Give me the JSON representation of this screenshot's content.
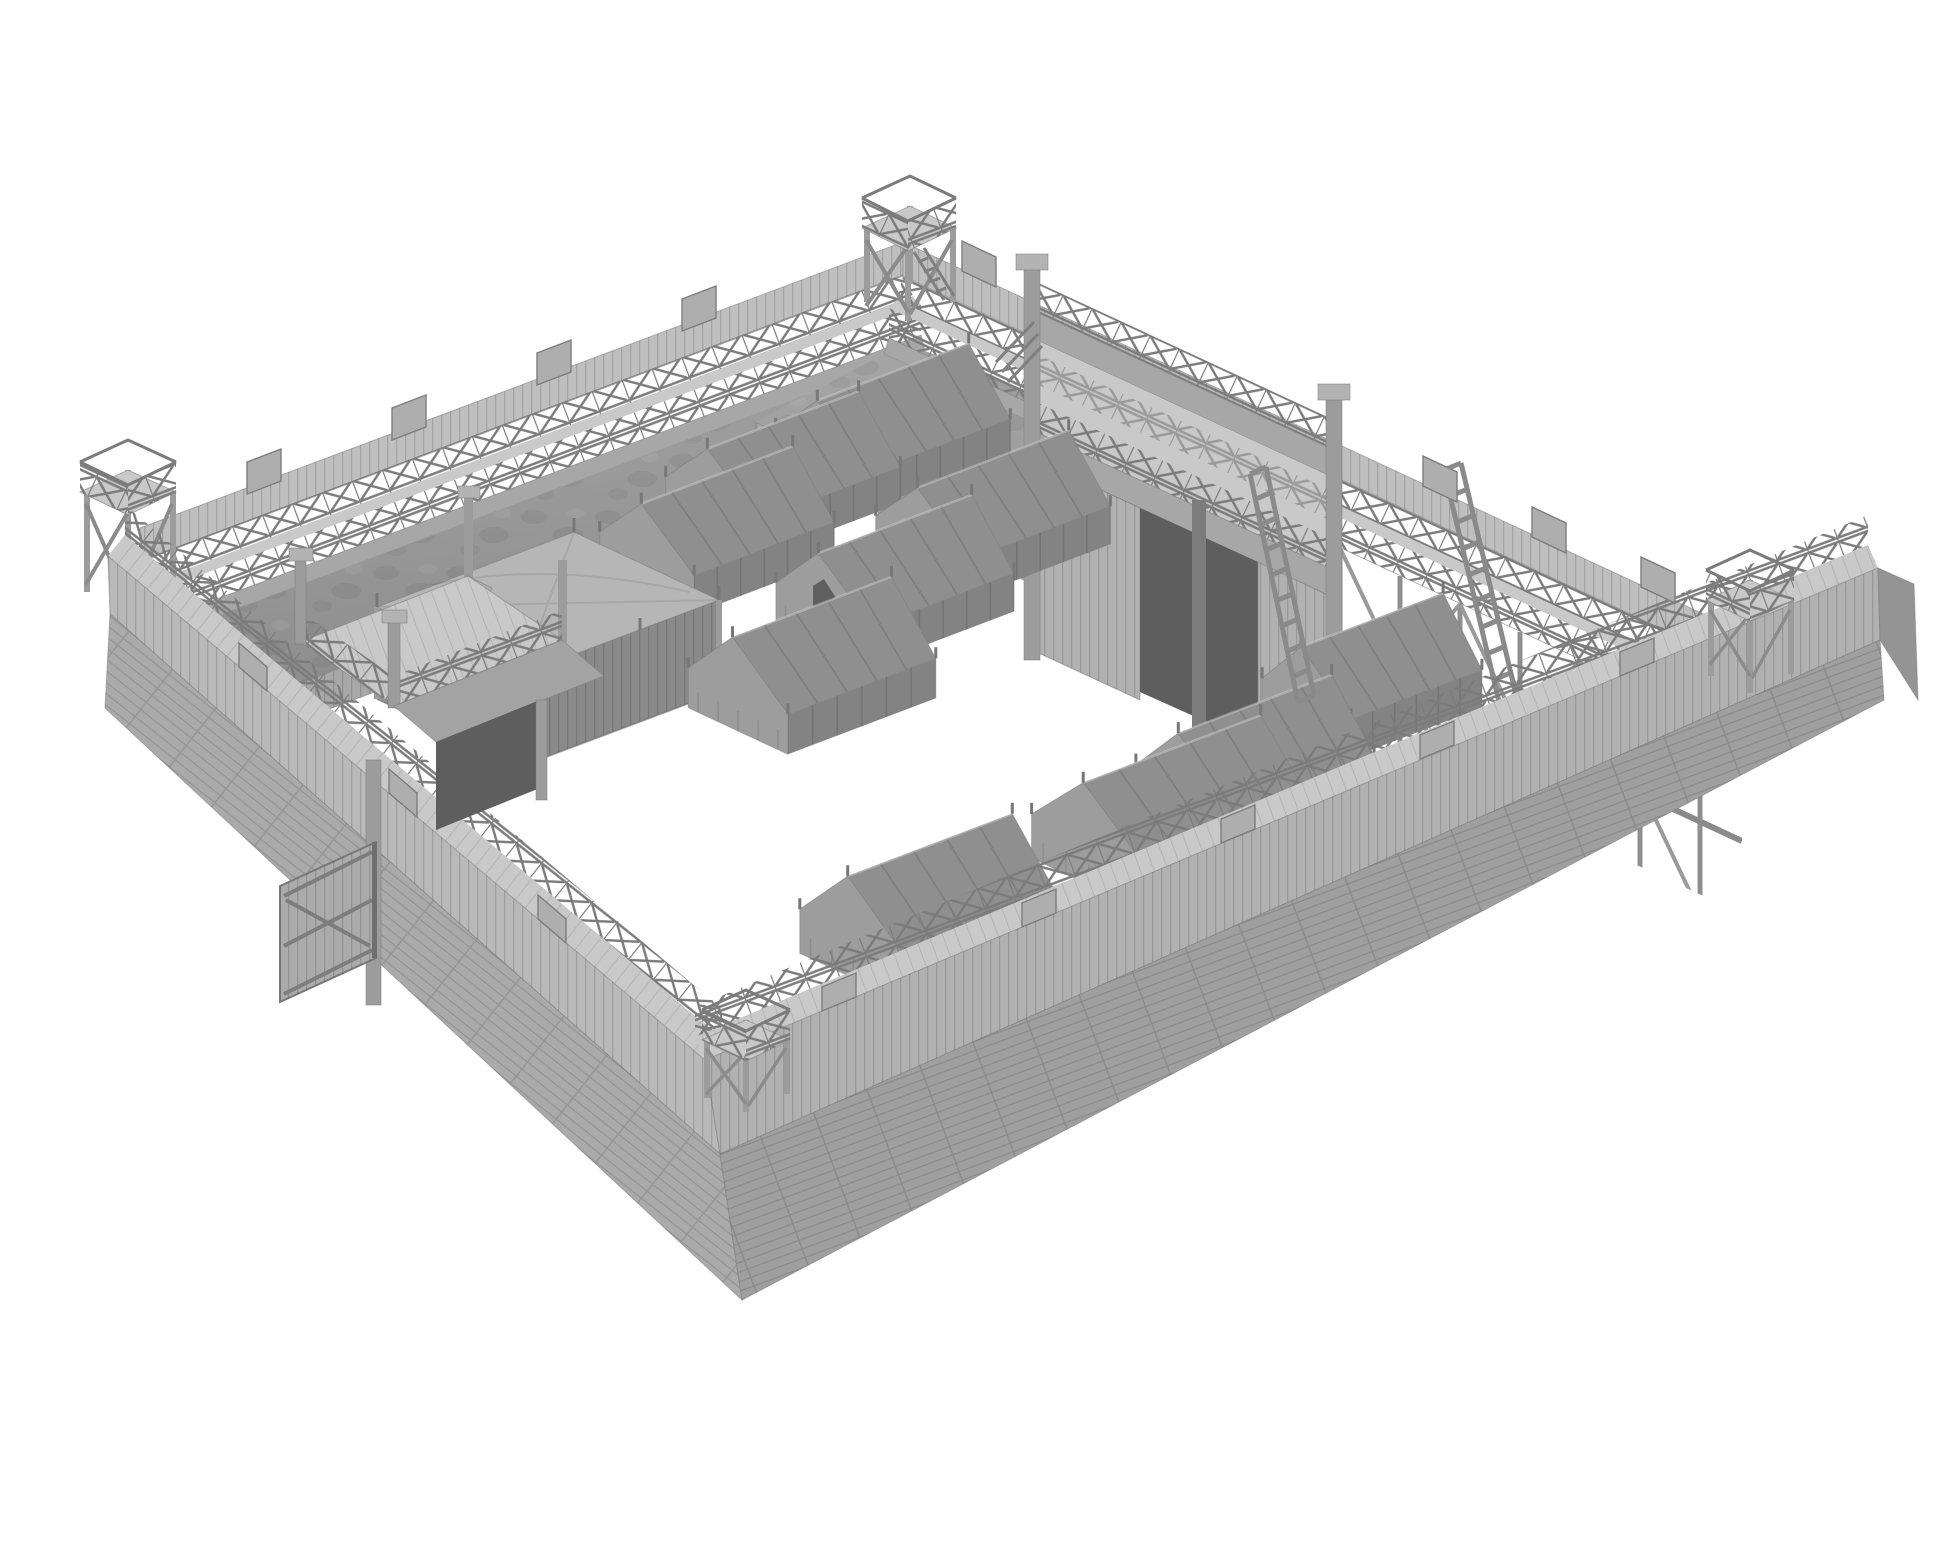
{
  "page": {
    "background": "#ffffff",
    "description": "Monochrome grey 3D render of a wooden palisade fort (Roman-style marching camp) shown in high isometric view on a plain white background. No text, UI chrome or labels are visible."
  },
  "colors": {
    "bg": "#ffffff",
    "paleTop": "#c9c9c9",
    "palisade": "#bfbfbf",
    "beamBand": "#a7a7a7",
    "earthLight": "#a3a3a3",
    "earthDark": "#8d8d8d",
    "revet": "#a8a8a8",
    "extVertSW": "#b9b9b9",
    "extHorizSW": "#aaaaaa",
    "extVertSE": "#b1b1b1",
    "extHorizSE": "#9f9f9f",
    "sideFacet": "#949494",
    "tentNear": "#8f8f8f",
    "tentFar": "#767676",
    "tentGable": "#9d9d9d",
    "tentSkirt": "#838383",
    "tentDark": "#5f5f5f",
    "pavTop": "#b6b6b6",
    "pavSide": "#9a9a9a",
    "pavFront": "#8a8a8a",
    "wood": "#aeaeae",
    "woodDark": "#8a8a8a",
    "postTone": "#9c9c9c",
    "capTone": "#b3b3b3",
    "gateDark": "#5e5e5e",
    "lattice": "#7b7b7b",
    "line": "#6f6f6f"
  },
  "scene": {
    "subject": "wooden fort model render",
    "view": "isometric from above, rotated rectangle, white void background",
    "fort": {
      "walls": [
        {
          "side": "northwest",
          "inner_face": "earth rampart with walkway, double cross-braced railing, log revetment"
        },
        {
          "side": "northeast",
          "inner_face": "earth rampart, walkway, open timber trestle section near east corner"
        },
        {
          "side": "southwest",
          "outer_face": "vertical stake palisade over horizontal log planking"
        },
        {
          "side": "southeast",
          "outer_face": "vertical stake palisade over horizontal log planking"
        }
      ],
      "corner_watchtowers": 4,
      "gatehouses": [
        {
          "side": "northeast",
          "stories": 2,
          "features": [
            "open gate passage",
            "two railed decks",
            "corner posts with caps"
          ]
        },
        {
          "side": "southwest",
          "stories": 2,
          "features": [
            "railed platform",
            "gate door swung open outward",
            "support post to ground",
            "internal stair"
          ]
        }
      ],
      "stairs_to_courtyard": 2,
      "leaning_ladders": 2,
      "raised_palisade_boards": "at intervals along all wall tops",
      "railing_style": "X cross-braced timber"
    },
    "camp": {
      "command_pavilion": 1,
      "ridge_tents": 10,
      "tents_with_open_flap": 1,
      "tent_style": "draped canvas A-frame with skirt and finial pegs"
    }
  },
  "tents": {
    "u": [
      0.935,
      -0.355
    ],
    "v": [
      0.907,
      0.422
    ],
    "items": [
      {
        "cx": 893,
        "cy": 460,
        "lu": 150,
        "wv": 104,
        "hb": 36,
        "hr": 88,
        "flap": false,
        "layer": "far"
      },
      {
        "cx": 783,
        "cy": 508,
        "lu": 150,
        "wv": 104,
        "hb": 36,
        "hr": 88,
        "flap": false,
        "layer": "far"
      },
      {
        "cx": 993,
        "cy": 549,
        "lu": 150,
        "wv": 104,
        "hb": 38,
        "hr": 90,
        "flap": false,
        "layer": "far"
      },
      {
        "cx": 717,
        "cy": 565,
        "lu": 150,
        "wv": 104,
        "hb": 38,
        "hr": 90,
        "flap": false,
        "layer": "far"
      },
      {
        "cx": 895,
        "cy": 616,
        "lu": 152,
        "wv": 106,
        "hb": 38,
        "hr": 92,
        "flap": true,
        "layer": "far"
      },
      {
        "cx": 812,
        "cy": 703,
        "lu": 158,
        "wv": 110,
        "hb": 40,
        "hr": 96,
        "flap": false,
        "layer": "near"
      },
      {
        "cx": 1372,
        "cy": 712,
        "lu": 140,
        "wv": 98,
        "hb": 38,
        "hr": 92,
        "flap": false,
        "layer": "near"
      },
      {
        "cx": 1255,
        "cy": 800,
        "lu": 152,
        "wv": 106,
        "hb": 40,
        "hr": 96,
        "flap": false,
        "layer": "near"
      },
      {
        "cx": 1172,
        "cy": 853,
        "lu": 178,
        "wv": 126,
        "hb": 44,
        "hr": 104,
        "flap": false,
        "layer": "near"
      },
      {
        "cx": 930,
        "cy": 949,
        "lu": 164,
        "wv": 118,
        "hb": 44,
        "hr": 104,
        "flap": false,
        "layer": "near"
      }
    ]
  },
  "ladders": {
    "items": [
      {
        "x1": 1250,
        "y1": 474,
        "x2": 1298,
        "y2": 702,
        "ox": 16,
        "oy": -7,
        "rungs": 9
      },
      {
        "x1": 1444,
        "y1": 470,
        "x2": 1500,
        "y2": 706,
        "ox": 17,
        "oy": -7,
        "rungs": 9
      }
    ]
  }
}
